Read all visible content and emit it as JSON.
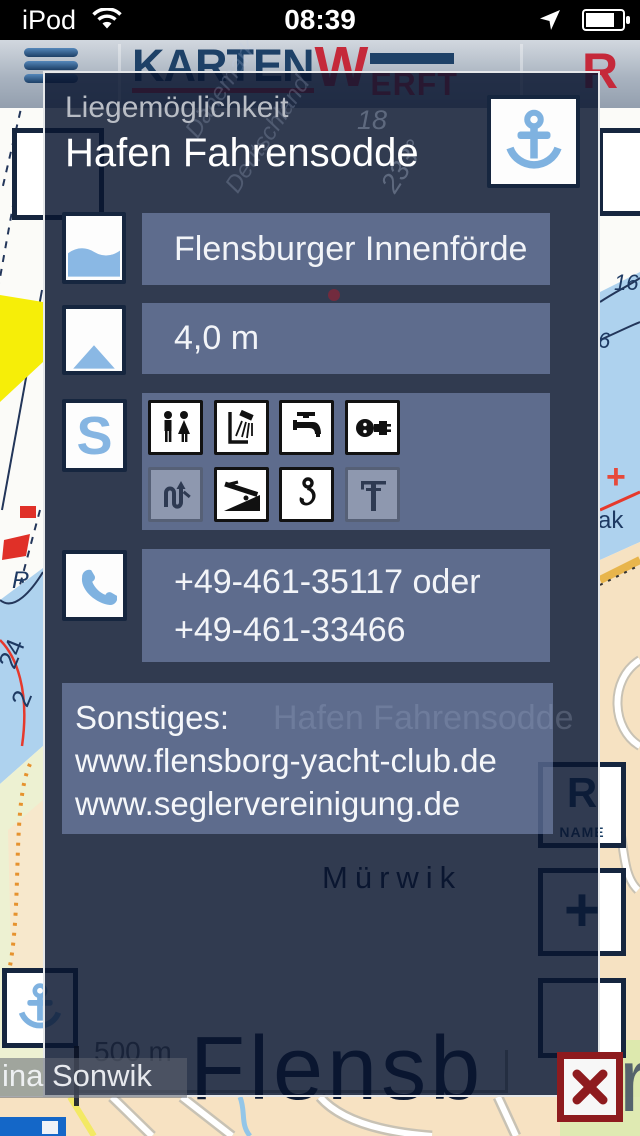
{
  "status_bar": {
    "carrier": "iPod",
    "time": "08:39"
  },
  "header": {
    "logo_karten": "KARTEN",
    "logo_w": "W",
    "logo_erft": "ERFT",
    "right_letter": "R"
  },
  "modal": {
    "label": "Liegemöglichkeit",
    "title": "Hafen Fahrensodde",
    "region": "Flensburger Innenförde",
    "depth": "4,0 m",
    "services_letter": "S",
    "services": [
      {
        "name": "wc",
        "active": true
      },
      {
        "name": "shower",
        "active": true
      },
      {
        "name": "water-tap",
        "active": true
      },
      {
        "name": "electricity",
        "active": true
      },
      {
        "name": "waste-pumpout",
        "active": false
      },
      {
        "name": "slipway",
        "active": true
      },
      {
        "name": "crane-hook",
        "active": true
      },
      {
        "name": "mast-crane",
        "active": false
      }
    ],
    "phone_line1": "+49-461-35117 oder",
    "phone_line2": "+49-461-33466",
    "sonstiges_heading": "Sonstiges:",
    "sonstiges_line1": "www.flensborg-yacht-club.de",
    "sonstiges_line2": "www.seglervereinigung.de"
  },
  "map": {
    "scale": "500 m",
    "marina_label": "ina Sonwik",
    "city_ghost": "Flensb",
    "city_letter": "r",
    "district_ghost": "Mürwik",
    "harbor_ghost": "Hafen Fahrensodde",
    "name_button_label": "NAME",
    "r_button_label": "R",
    "plus_button_label": "+",
    "depth_24": "24",
    "depth_2": "2",
    "depth_16": "16",
    "depth_6": "6",
    "depth_18": "18",
    "bearing_233": "233°",
    "text_ak": "ak",
    "chart_r": "R",
    "ghost_country1": "Dänemark",
    "ghost_country2": "Deutschland"
  },
  "colors": {
    "accent_blue": "#7fb2e0",
    "logo_navy": "#1e4167",
    "logo_red": "#c5293a",
    "close_red": "#8e1b1e",
    "modal_navy": "#2f3a55"
  }
}
